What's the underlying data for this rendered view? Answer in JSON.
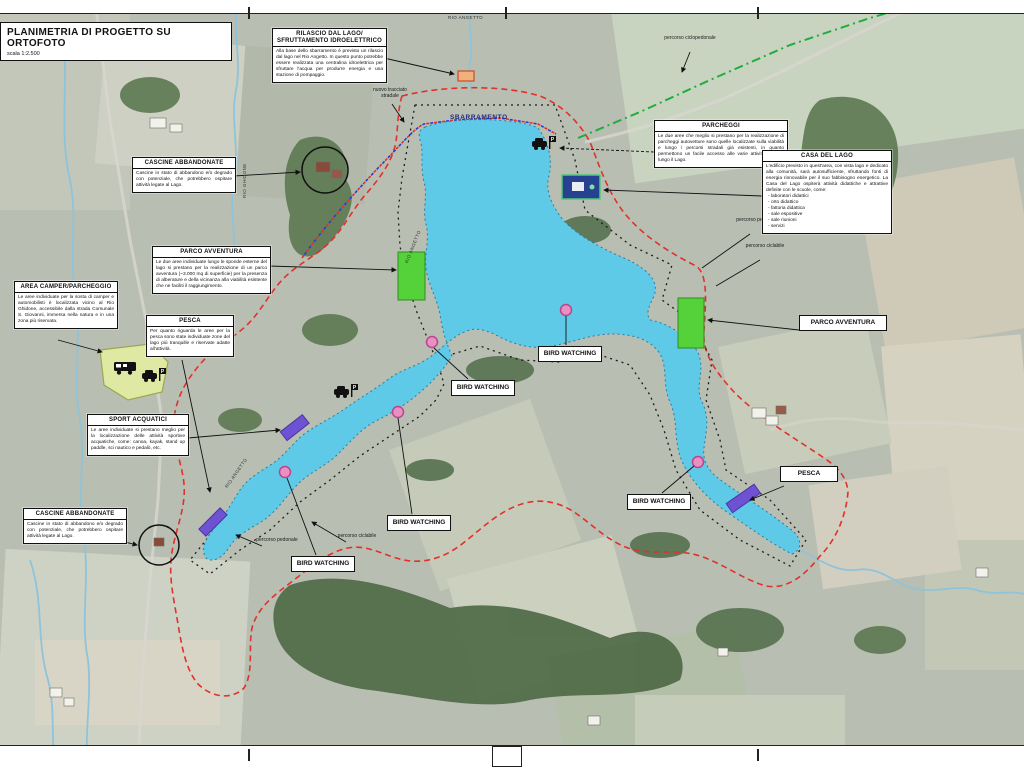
{
  "sheet": {
    "title": "PLANIMETRIA DI PROGETTO SU ORTOFOTO",
    "scale": "scala 1:2.500"
  },
  "colors": {
    "lake": "#5fc9e8",
    "lake_edge": "#2a7d99",
    "route_red": "#e0312a",
    "trail_black": "#1c1c1c",
    "route_green": "#1fae3d",
    "route_blue": "#2b3bd0",
    "parco_green": "#55d23a",
    "sport_purple": "#6f52d4",
    "bird_pink": "#ea8fc2",
    "camper_yellow": "#dfe9a4",
    "parking_blue": "#27408f",
    "dam_release_orange": "#f0b27a"
  },
  "callouts": {
    "rilascio": {
      "title": "RILASCIO DAL LAGO/ SFRUTTAMENTO IDROELETTRICO",
      "body": "Alla base dello sbarramento è previsto un rilascio dal lago nel Rio Angetto. In questo punto potrebbe essere realizzata una centralina idroelettrica per sfruttare l'acqua per produrre energia e una stazione di pompaggio."
    },
    "parcheggi": {
      "title": "PARCHEGGI",
      "body": "Le due aree che meglio si prestano per la realizzazione di parcheggi autovetture sono quelle localizzate sulla viabilità e lungo i percorsi stradali già esistenti, in quanto permettono un facile accesso alle varie attività previste lungo il Lago."
    },
    "casa_del_lago": {
      "title": "CASA DEL LAGO",
      "body": "L'edificio previsto in quest'area, con vista lago e dedicato alla comunità, sarà autosufficiente, sfruttando fonti di energia rinnovabile per il suo fabbisogno energetico. La Casa del Lago ospiterà attività didattiche e attrattive definite con le scuole, come:",
      "items": [
        "laboratori didattici",
        "orto didattico",
        "fattoria didattica",
        "sale espositive",
        "sale riunioni",
        "servizi"
      ]
    },
    "cascine": {
      "title": "CASCINE ABBANDONATE",
      "body": "Cascine in stato di abbandono e/o degrado con potenziale, che potrebbero ospitare attività legate al Lago."
    },
    "parco_avventura": {
      "title": "PARCO AVVENTURA",
      "body": "Le due aree individuate lungo le sponde esterne del lago si prestano per la realizzazione di un parco avventura (~3.000 mq di superficie) per la presenza di alberature e della vicinanza alla viabilità esistente che ne faciliti il raggiungimento."
    },
    "area_camper": {
      "title": "AREA CAMPER/PARCHEGGIO",
      "body": "Le aree individuate per la sosta di camper e automobilisti è localizzata vicino al Rio Ghidone, accessibile dalla strada Comunale S. Giovanni, immersa nella natura e in una zona più riservata."
    },
    "pesca": {
      "title": "PESCA",
      "body": "Per quanto riguarda le aree per la pesca sono state individuate zone del lago più tranquille e riservate adatte all'attività."
    },
    "sport_acquatici": {
      "title": "SPORT ACQUATICI",
      "body": "Le aree individuate si prestano meglio per la localizzazione delle attività sportive acquatiche, come: canoa, kayak, stand up paddle, sci nautico e pedalò, etc."
    }
  },
  "labels": {
    "bird_watching": "BIRD WATCHING",
    "parco_avventura": "PARCO AVVENTURA",
    "pesca": "PESCA",
    "sbarramento": "SBARRAMENTO",
    "nuovo_tracciato": "nuovo tracciato stradale",
    "percorso_ciclopedonale": "percorso ciclopedonale",
    "percorso_pedonale": "percorso pedonale",
    "percorso_ciclabile": "percorso ciclabile",
    "rio_angetto": "RIO ANGETTO",
    "rio_ghidone": "RIO GHIDONE"
  }
}
